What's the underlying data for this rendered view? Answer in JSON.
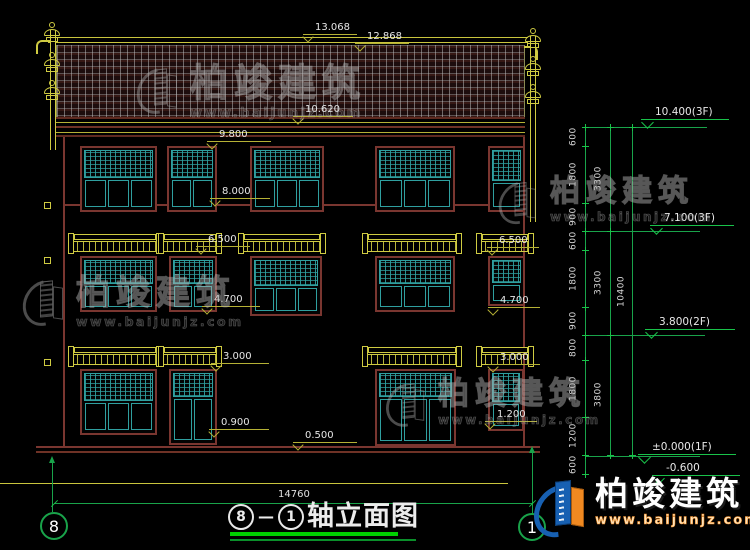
{
  "drawing": {
    "title_axis_a": "8",
    "title_dash": "—",
    "title_axis_b": "1",
    "title_text": "轴立面图",
    "bottom_width_dim": "14760",
    "axis_bubble_left": "8",
    "axis_bubble_right": "1"
  },
  "top_dims": {
    "d1": "13.068",
    "d2": "12.868"
  },
  "elev_labels": {
    "e10620": "10.620",
    "e9800": "9.800",
    "e8000": "8.000",
    "e6500_l": "6.500",
    "e6500_r": "6.500",
    "e4700_l": "4.700",
    "e4700_r": "4.700",
    "e3000_l": "3.000",
    "e3000_r": "3.000",
    "e0900": "0.900",
    "e1200": "1.200",
    "e0500": "0.500"
  },
  "levels": {
    "l_roof": "10.400(3F)",
    "l_3f": "7.100(3F)",
    "l_2f": "3.800(2F)",
    "l_1f": "±0.000(1F)",
    "l_base": "-0.600"
  },
  "dim_chain": {
    "segments": [
      "600",
      "1800",
      "900",
      "600",
      "1800",
      "900",
      "800",
      "1800",
      "1200",
      "600"
    ],
    "subtotals": [
      "3300",
      "3300",
      "3800"
    ],
    "total": "10400"
  },
  "watermark": {
    "brand": "柏竣建筑",
    "url": "www.baijunjz.com"
  },
  "colors": {
    "cad_yellow": "#cfcb42",
    "cad_green": "#19a34a",
    "cad_teal": "#2f9f9f",
    "cad_darkred": "#7a3630",
    "brand_blue": "#1760b2",
    "brand_orange": "#f08921",
    "title_green": "#00d000"
  }
}
